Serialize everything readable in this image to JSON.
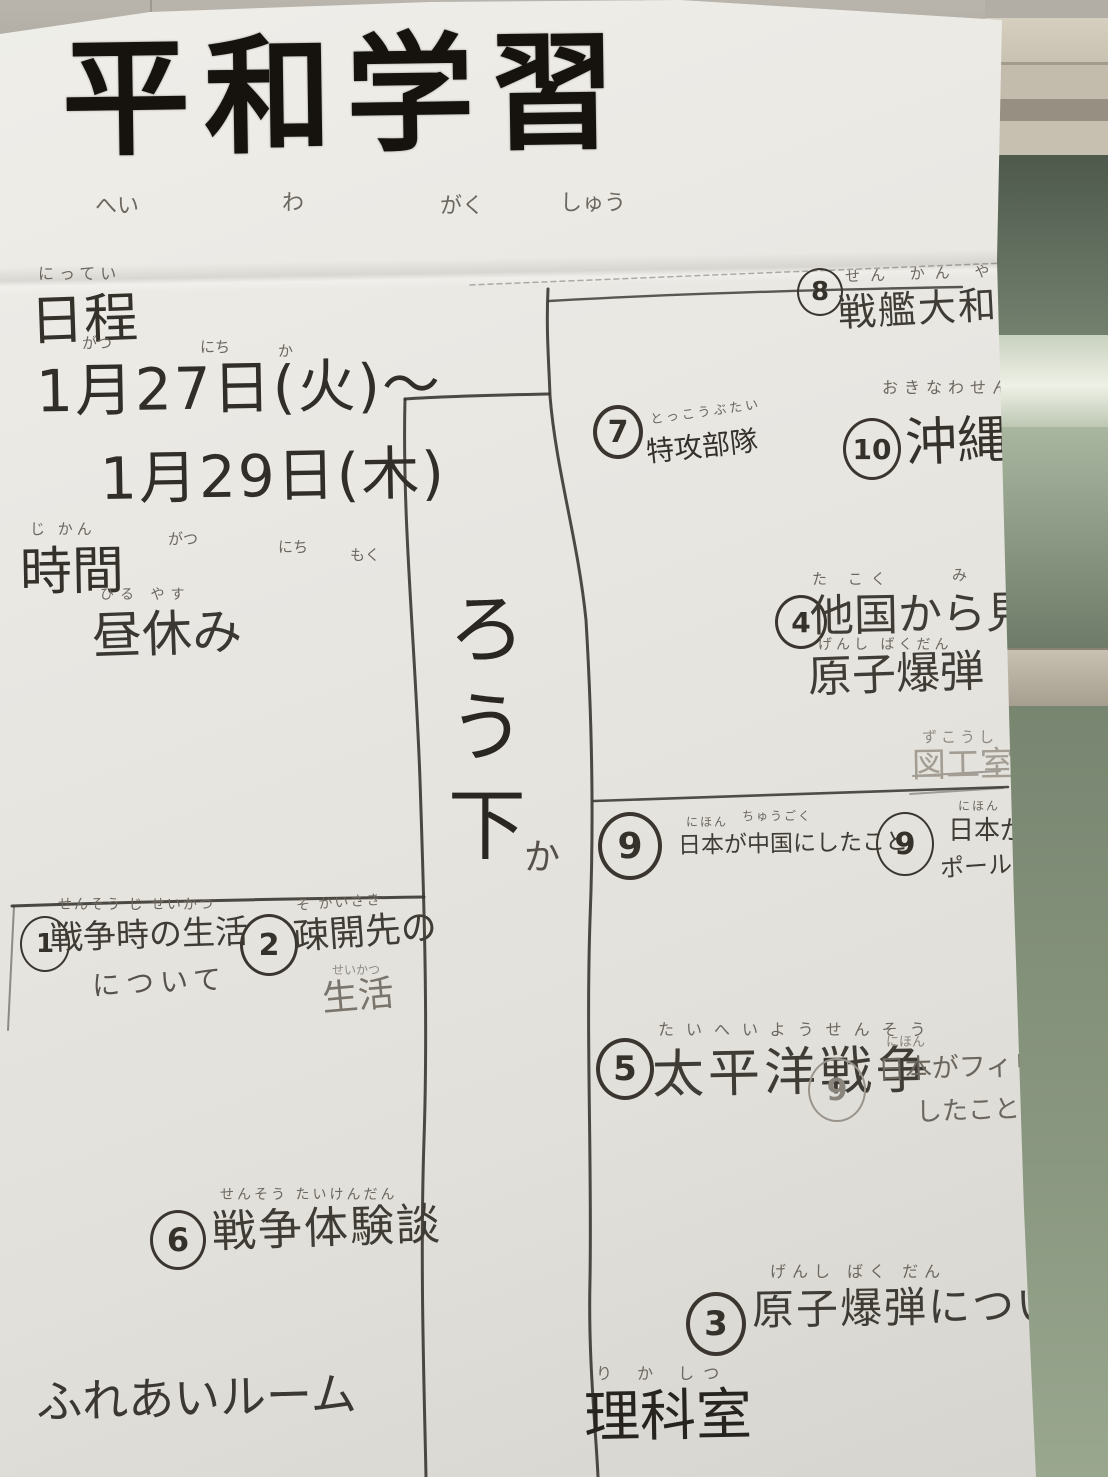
{
  "title": {
    "text": "平和学習",
    "furigana_parts": [
      "へい",
      "わ",
      "がく",
      "しゅう"
    ]
  },
  "schedule": {
    "heading_furigana": "にってい",
    "heading": "日程",
    "line1": "1月27日(火)〜",
    "line1_furigana": {
      "gatsu": "がつ",
      "nichi": "にち",
      "ka": "か"
    },
    "line2": "1月29日(木)",
    "line2_furigana": {
      "gatsu": "がつ",
      "nichi": "にち",
      "moku": "もく"
    }
  },
  "time": {
    "heading_furigana": "じ かん",
    "heading": "時間",
    "value_furigana": "ひる やす",
    "value": "昼休み"
  },
  "corridor": {
    "text": "ろう下",
    "furigana": "か"
  },
  "stations": {
    "s1": {
      "number": "1",
      "furigana": "せんそう じ せいかつ",
      "line1": "戦争時の生活",
      "line2": "について"
    },
    "s2": {
      "number": "2",
      "furigana": "そ かいさき",
      "line1": "疎開先の",
      "line2_furigana": "せいかつ",
      "line2": "生活"
    },
    "s3": {
      "number": "3",
      "furigana": "げんし ばく だん",
      "line1": "原子爆弾につい"
    },
    "s4": {
      "number": "4",
      "furigana": "た こく",
      "furigana_mi": "み",
      "line1": "他国から見た",
      "line2_furigana": "げんし ばくだん",
      "line2": "原子爆弾"
    },
    "s5": {
      "number": "5",
      "furigana": "たいへいようせんそう",
      "line1": "太平洋戦争"
    },
    "s6": {
      "number": "6",
      "furigana": "せんそう たいけんだん",
      "line1": "戦争体験談"
    },
    "s7": {
      "number": "7",
      "furigana": "とっこうぶたい",
      "line1": "特攻部隊"
    },
    "s8": {
      "number": "8",
      "furigana": "せん かん やまと",
      "line1": "戦艦大和"
    },
    "s9a": {
      "number": "9",
      "furigana_nihon": "にほん",
      "furigana_chugoku": "ちゅうごく",
      "line1": "日本が中国にしたこと"
    },
    "s9b": {
      "number": "9",
      "furigana": "にほん",
      "line1": "日本がシン",
      "line2": "ポールにした"
    },
    "s9c": {
      "number": "9",
      "furigana": "にほん",
      "line1": "日本がフィリピ",
      "line2": "したこと"
    },
    "s10": {
      "number": "10",
      "furigana": "おきなわせん",
      "line1": "沖縄戦"
    }
  },
  "rooms": {
    "fureai": {
      "name": "ふれあいルーム"
    },
    "rika": {
      "furigana": "り か しつ",
      "name": "理科室"
    },
    "zuko": {
      "furigana": "ずこうし",
      "name": "図工室"
    }
  }
}
